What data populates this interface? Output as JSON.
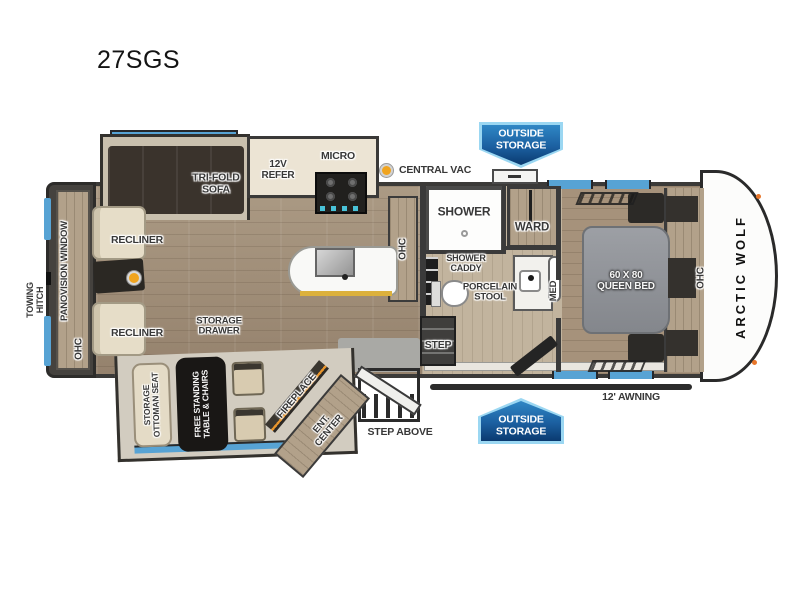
{
  "model": "27SGS",
  "brand": "ARCTIC WOLF",
  "labels": {
    "outside_storage_top": "OUTSIDE STORAGE",
    "outside_storage_bottom": "OUTSIDE STORAGE",
    "central_vac": "CENTRAL VAC",
    "towing_hitch": "TOWING HITCH",
    "panovision_window": "PANOVISION WINDOW",
    "ohc_rear": "OHC",
    "ohc_kitchen": "OHC",
    "ohc_front": "OHC",
    "recliner_top": "RECLINER",
    "recliner_bottom": "RECLINER",
    "tri_fold_sofa": "TRI-FOLD SOFA",
    "refer_12v": "12V REFER",
    "micro": "MICRO",
    "shower": "SHOWER",
    "shower_caddy": "SHOWER CADDY",
    "ward": "WARD",
    "porcelain_stool": "PORCELAIN STOOL",
    "med": "MED",
    "queen_bed": "60 X 80 QUEEN BED",
    "storage_drawer": "STORAGE DRAWER",
    "storage_ottoman_seat": "STORAGE OTTOMAN SEAT",
    "free_standing_table_chairs": "FREE STANDING TABLE & CHAIRS",
    "fireplace": "FIREPLACE",
    "ent_center": "ENT. CENTER",
    "step": "STEP",
    "step_above": "STEP ABOVE",
    "awning": "12' AWNING"
  },
  "colors": {
    "badge_blue_dark": "#0a3a70",
    "badge_blue_mid": "#2f87c5",
    "badge_blue_edge": "#9bd7f2",
    "window_blue": "#57a3d4",
    "wall_dark": "#3a3a3a",
    "wood_floor": "#a5937d",
    "accent_orange": "#f0a41f",
    "fireplace_orange": "#e8952c",
    "bed_gray": "#8f9298",
    "upholstery_cream": "#e4dbc6"
  }
}
